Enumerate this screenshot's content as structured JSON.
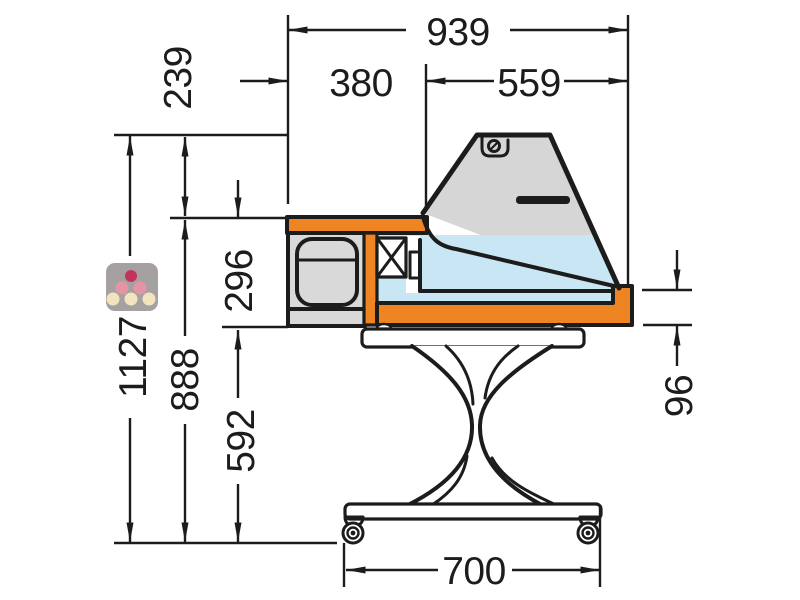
{
  "diagram": {
    "type": "technical-drawing",
    "subject": "refrigerated-display-counter-side-elevation",
    "dimensions": {
      "overall_depth": "939",
      "rear_depth": "380",
      "front_glass_depth": "559",
      "hood_height": "239",
      "well_height": "296",
      "overall_height": "1127",
      "worktop_height": "888",
      "underframe_height": "592",
      "bumper_height": "96",
      "base_depth": "700"
    },
    "colors": {
      "line": "#1c1c1c",
      "accent_orange": "#ee8522",
      "glass_gray": "#d6d6d6",
      "panel_gray": "#d9d9d9",
      "interior_blue": "#c9e6f5",
      "logo_gray": "#8f8a8a",
      "grape_top": "#c5325c",
      "grape_mid": "#e495a5",
      "grape_bottom": "#f3e4c0"
    }
  }
}
